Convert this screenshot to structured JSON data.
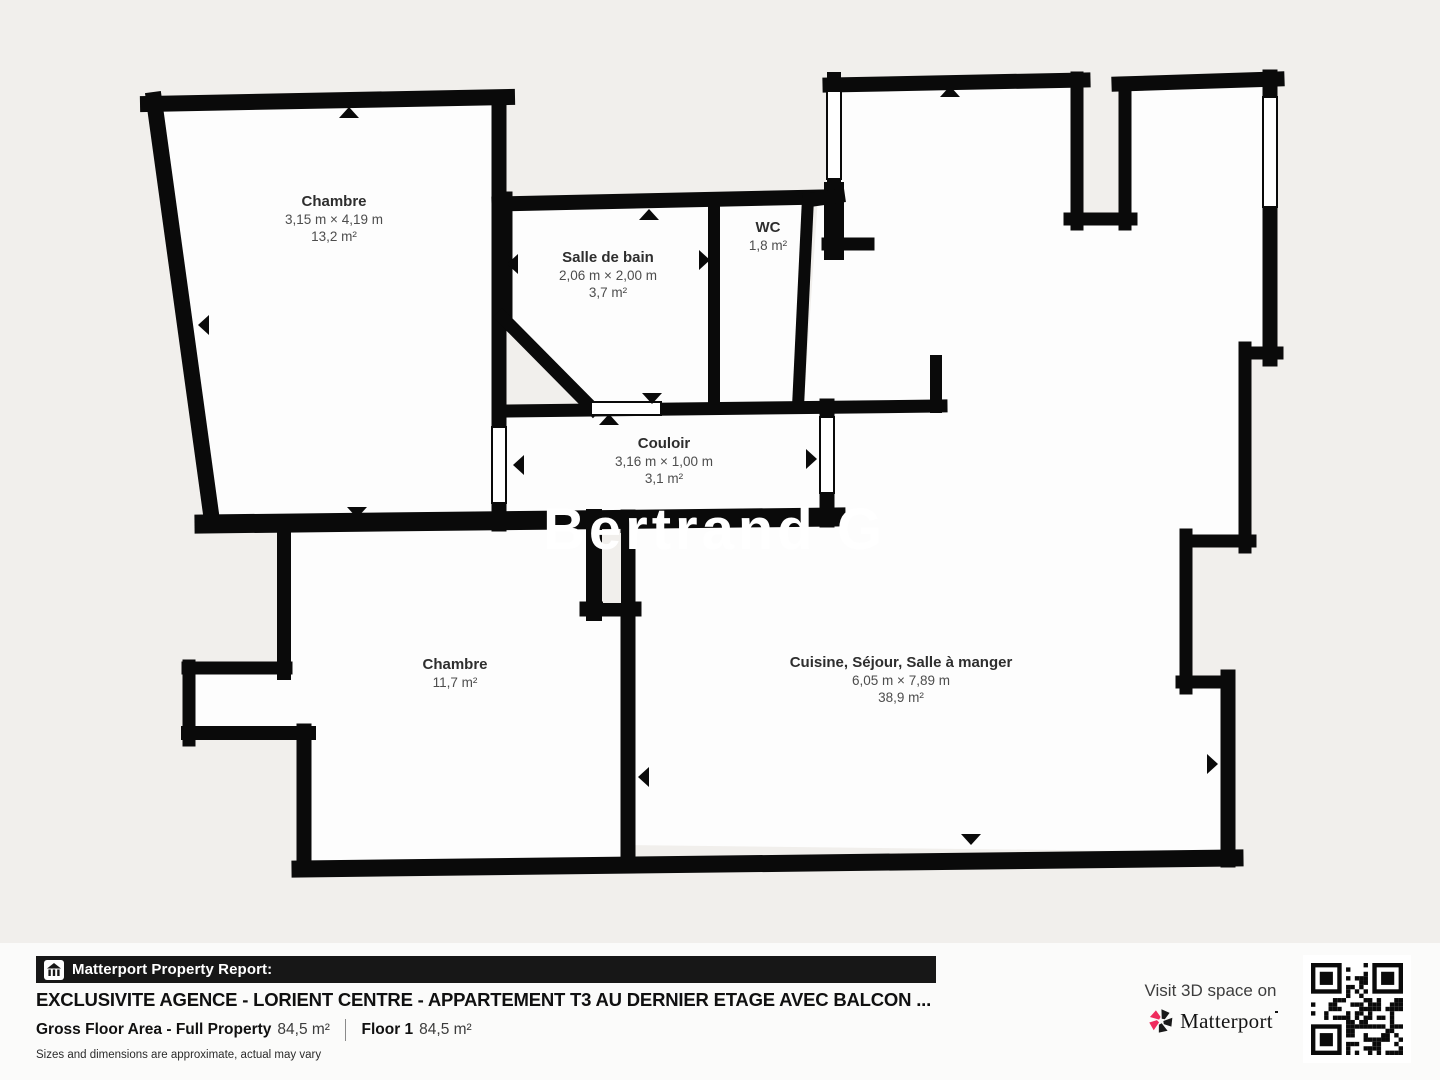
{
  "plan": {
    "background": "#f1efec",
    "wall_color": "#0a0a0a",
    "room_fill": "#fdfdfd",
    "watermark": "Bertrand G",
    "rooms": [
      {
        "id": "chambre-1",
        "name": "Chambre",
        "dimensions": "3,15 m × 4,19 m",
        "area": "13,2 m²"
      },
      {
        "id": "salle-de-bain",
        "name": "Salle de bain",
        "dimensions": "2,06 m × 2,00 m",
        "area": "3,7 m²"
      },
      {
        "id": "wc",
        "name": "WC",
        "dimensions": "",
        "area": "1,8 m²"
      },
      {
        "id": "couloir",
        "name": "Couloir",
        "dimensions": "3,16 m × 1,00 m",
        "area": "3,1 m²"
      },
      {
        "id": "chambre-2",
        "name": "Chambre",
        "dimensions": "",
        "area": "11,7 m²"
      },
      {
        "id": "cuisine-sejour",
        "name": "Cuisine, Séjour, Salle à manger",
        "dimensions": "6,05 m × 7,89 m",
        "area": "38,9 m²"
      }
    ]
  },
  "footer": {
    "report_label": "Matterport Property Report:",
    "title": "EXCLUSIVITE AGENCE - LORIENT CENTRE - APPARTEMENT T3 AU DERNIER ETAGE AVEC BALCON ...",
    "gross_floor_label": "Gross Floor Area - Full Property",
    "gross_floor_value": "84,5 m²",
    "floor_label": "Floor 1",
    "floor_value": "84,5 m²",
    "disclaimer": "Sizes and dimensions are approximate, actual may vary",
    "visit_label": "Visit 3D space on",
    "brand": "Matterport",
    "brand_red": "#ef2b5d"
  }
}
